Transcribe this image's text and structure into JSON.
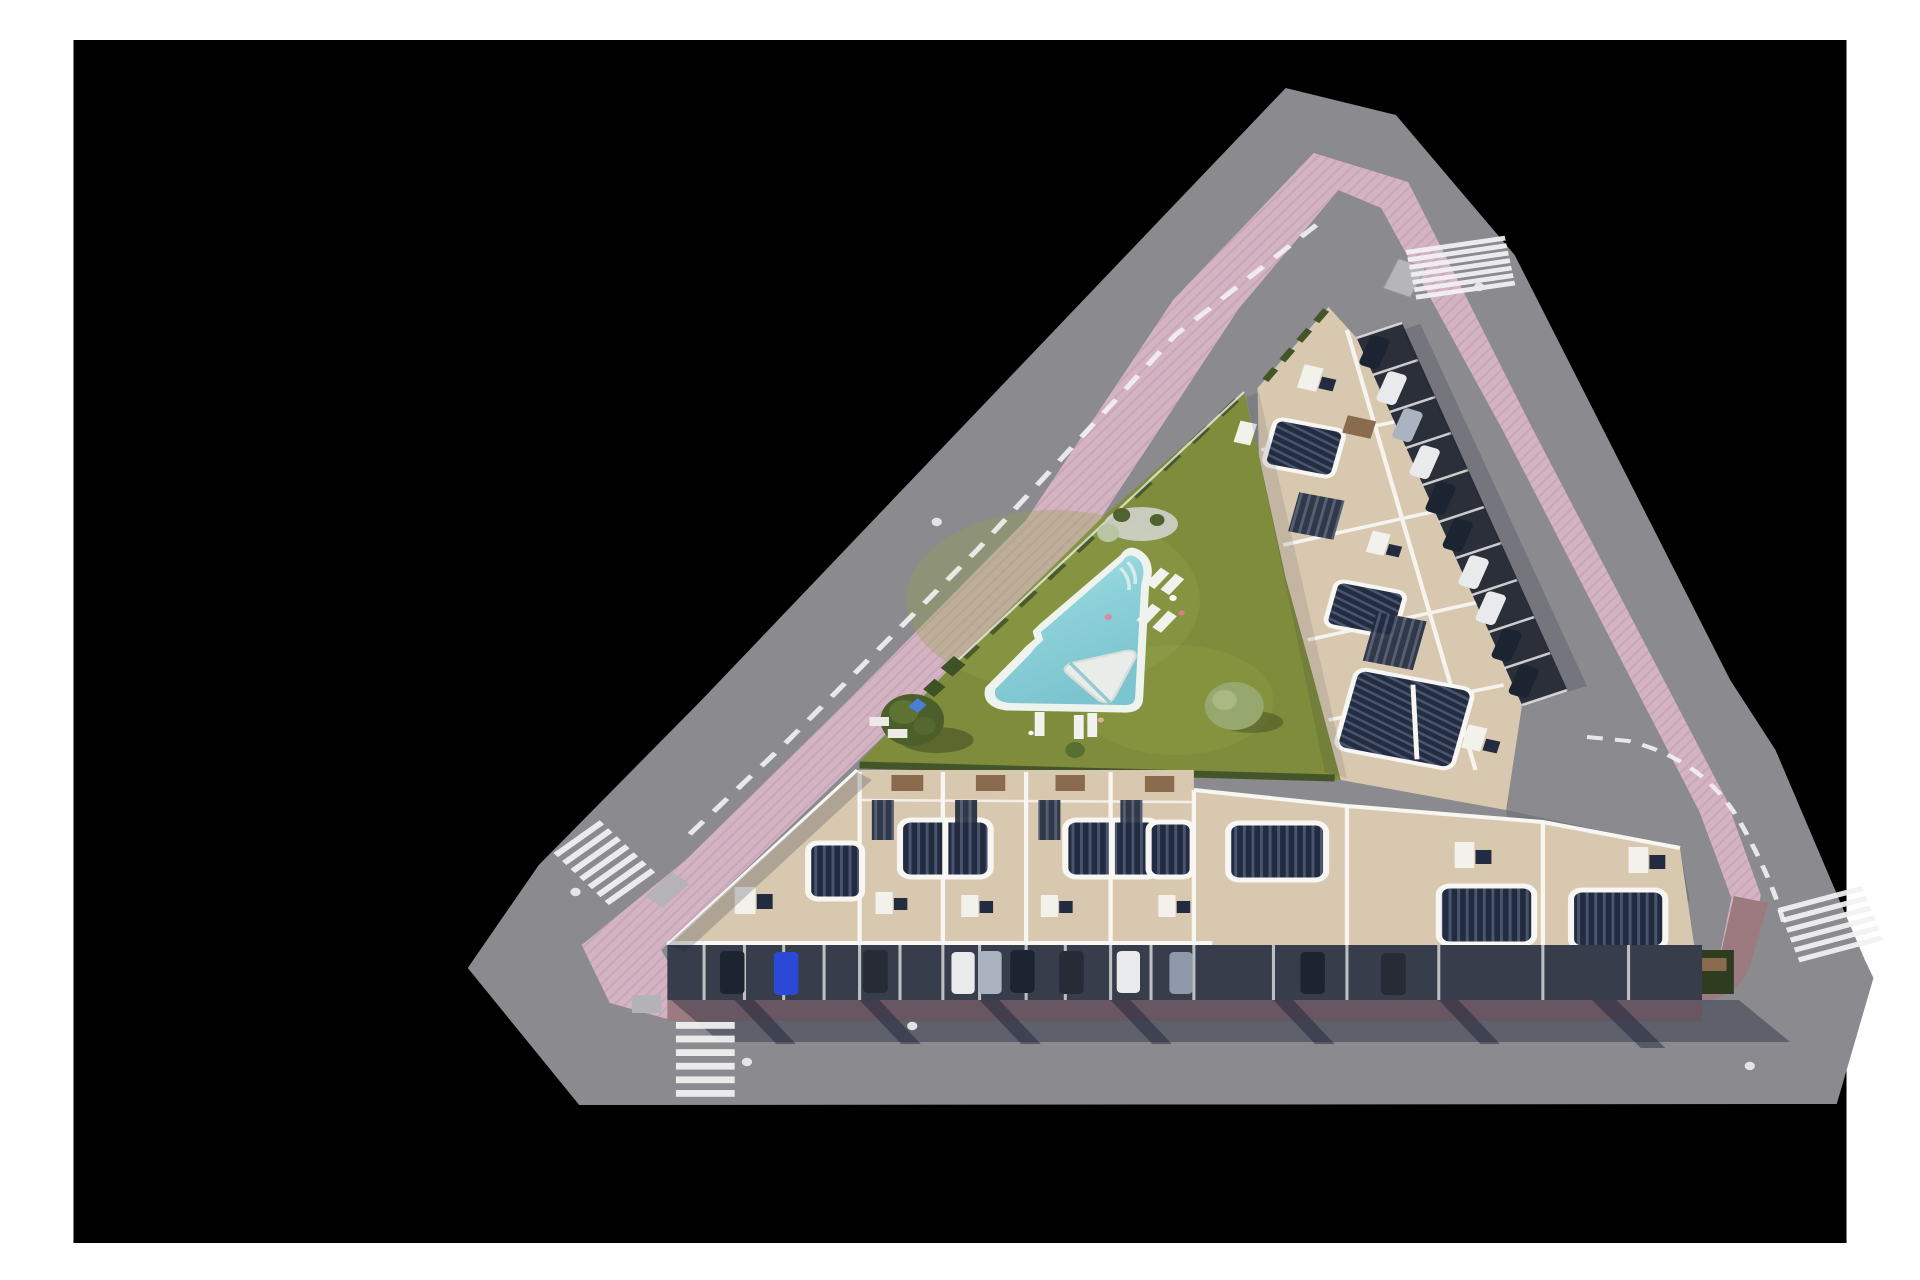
{
  "scene": {
    "kind": "aerial-site-plan-render",
    "description_elements": [
      "triangular-plot",
      "perimeter-roads",
      "pink-sidewalk-ring",
      "garden-with-pool",
      "apartment-block-northeast",
      "townhouse-row-south",
      "corner-wing-southeast"
    ],
    "crosswalk_count": 4,
    "manhole_count": 6,
    "road_dashed_lines": 2,
    "pool": {
      "shape": "rounded-triangle",
      "deck_island": "white-triangle",
      "sun_loungers": 7,
      "swimmers": 1
    },
    "parking_bays_east": 10,
    "garage_cars_south": 11,
    "trees": 4
  },
  "colors": {
    "page": "#ffffff",
    "bg": "#000000",
    "road": "#8a8a8f",
    "sidewalk": "#d4b3c3",
    "sidewalk-stripe": "#c29cb1",
    "brick": "#9b7b80",
    "grass": "#7e8c3c",
    "grass-light": "#95a44a",
    "grass-dark": "#5c6c2d",
    "pool": "#8ed2da",
    "pool-light": "#bfe4e6",
    "pool-rim": "#eff3ee",
    "deck": "#e9ede9",
    "terrace": "#d9c8b0",
    "wall": "#f7f6f2",
    "pergola": "#222b3f",
    "slat": "#4a5670",
    "asphalt": "#383d4b",
    "bays": "#2b2f3a",
    "shadow": "rgba(28,33,55,0.40)",
    "hedge": "#44552a",
    "white-line": "#f2f2f2",
    "table": "#8a6b4e",
    "dumpster": "#b5b5ba",
    "car-navy": "#1c2432",
    "car-blue": "#2a49d6",
    "car-white": "#e9eaec",
    "car-silver": "#aab3bf",
    "car-gray": "#8f99a9",
    "car-dark": "#262b36"
  },
  "cars": {
    "garage_row_colors": [
      "car-navy",
      "car-blue",
      "car-dark",
      "car-white",
      "car-silver",
      "car-navy",
      "car-dark",
      "car-white",
      "car-gray",
      "car-navy",
      "car-navy"
    ],
    "east_parking_colors": [
      "car-navy",
      "car-white",
      "car-silver",
      "car-white",
      "car-navy",
      "car-navy",
      "car-white",
      "car-white",
      "car-navy",
      "car-navy"
    ]
  }
}
